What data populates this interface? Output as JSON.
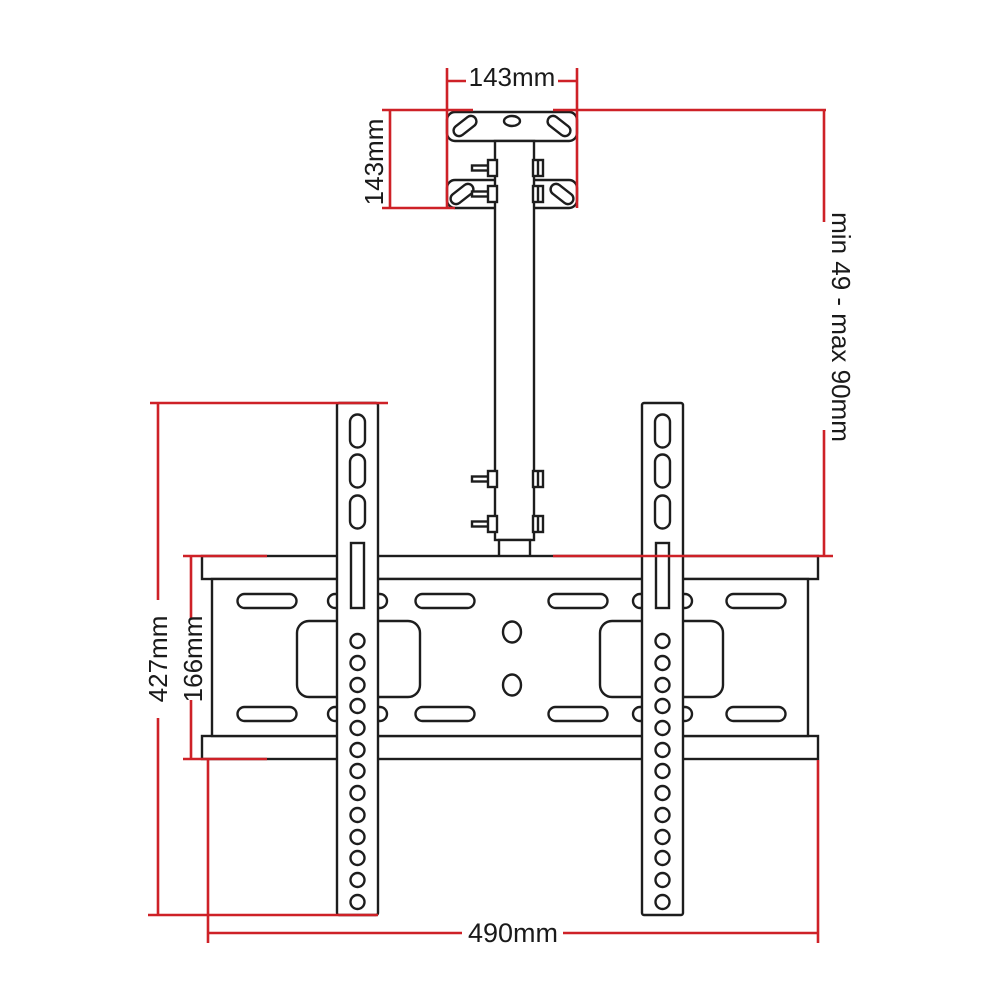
{
  "title": "TV ceiling mount bracket dimension diagram",
  "colors": {
    "dimension_line": "#ce2127",
    "outline": "#1d1d1d",
    "background": "#ffffff"
  },
  "dimensions": {
    "ceiling_plate_width": {
      "label": "143mm"
    },
    "upper_assembly_height": {
      "label": "143mm"
    },
    "pole_adjustment_range": {
      "label": "min 49 - max 90mm"
    },
    "bracket_total_height": {
      "label": "427mm"
    },
    "center_plate_height": {
      "label": "166mm"
    },
    "bracket_width": {
      "label": "490mm"
    }
  }
}
